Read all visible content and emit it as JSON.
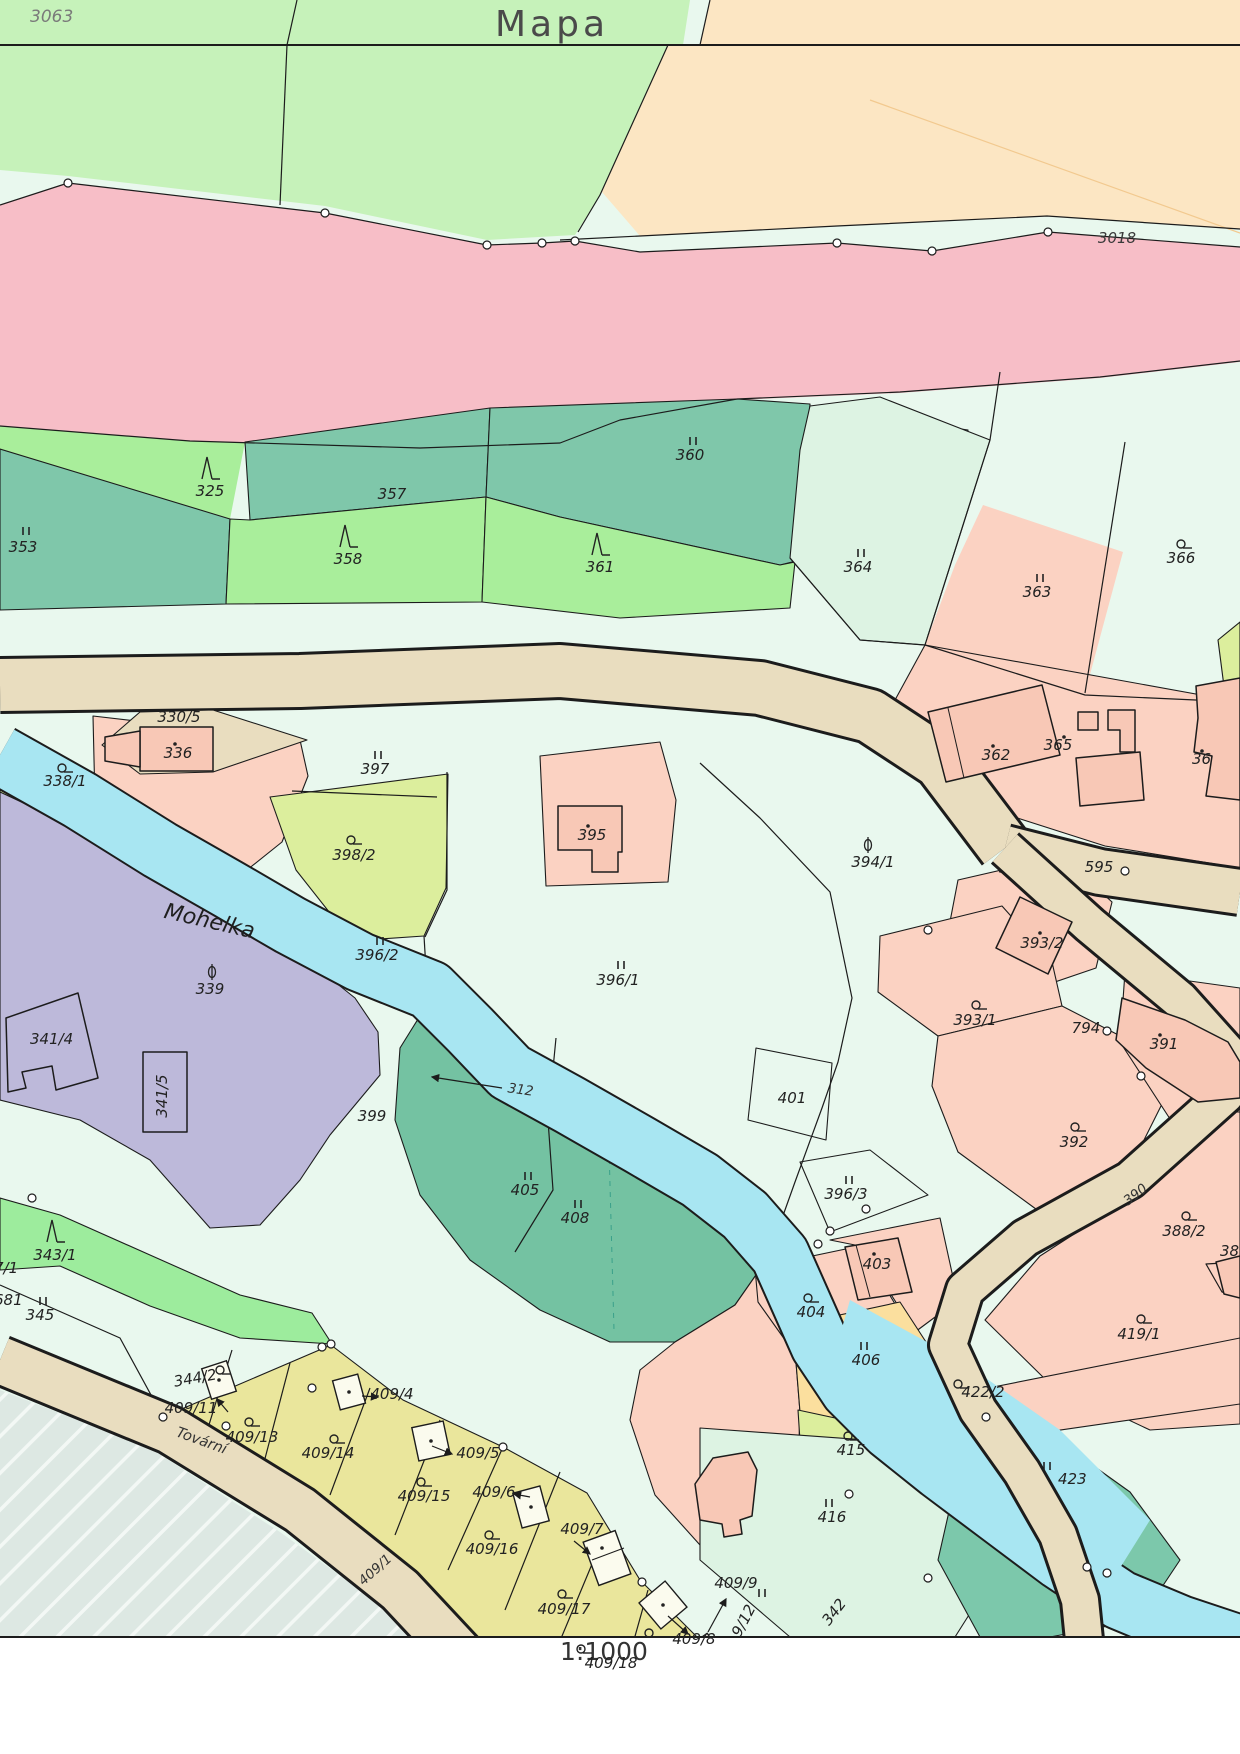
{
  "sheet": {
    "title": "Mapa",
    "scale": "1:1000",
    "sheet_number_top_left": "3063",
    "road_parcel_top_right": "3018",
    "river_name": "Mohelka",
    "street_name": "Tovární"
  },
  "colors": {
    "road_beige": "#e9ddbf",
    "water_cyan": "#a8e6f2",
    "forest_teal": "#7fc7aa",
    "meadow_mint": "#e9f8ee",
    "garden_salmon": "#fbd2c2",
    "field_green": "#a9ee9b",
    "builtup_yellow": "#eae69c",
    "band_pink": "#f7bec7",
    "field_peach": "#fce6c3",
    "area_purple": "#bdb9da",
    "grass_yellowgreen": "#dcee9d",
    "other_gray": "#dde8e3"
  },
  "labels": [
    {
      "t": "3063",
      "x": 30,
      "y": 22,
      "c": "c-sheet",
      "a": "s"
    },
    {
      "t": "Mapa",
      "x": 552,
      "y": 36,
      "c": "c-title"
    },
    {
      "t": "3018",
      "x": 1117,
      "y": 243,
      "c": "c-small"
    },
    {
      "t": "1:1000",
      "x": 604,
      "y": 1660,
      "c": "c-scale"
    },
    {
      "t": "353",
      "x": 23,
      "y": 552,
      "s": "meadow",
      "sx": 26,
      "sy": 532
    },
    {
      "t": "325",
      "x": 210,
      "y": 496,
      "s": "conifer",
      "sx": 207,
      "sy": 470
    },
    {
      "t": "357",
      "x": 392,
      "y": 499
    },
    {
      "t": "358",
      "x": 348,
      "y": 564,
      "s": "conifer",
      "sx": 345,
      "sy": 538
    },
    {
      "t": "360",
      "x": 690,
      "y": 460,
      "s": "meadow",
      "sx": 693,
      "sy": 442
    },
    {
      "t": "361",
      "x": 600,
      "y": 572,
      "s": "conifer",
      "sx": 597,
      "sy": 546
    },
    {
      "t": "364",
      "x": 858,
      "y": 572,
      "s": "meadow",
      "sx": 861,
      "sy": 554
    },
    {
      "t": "363",
      "x": 1037,
      "y": 597,
      "s": "meadow",
      "sx": 1040,
      "sy": 579
    },
    {
      "t": "366",
      "x": 1181,
      "y": 563,
      "s": "garden",
      "sx": 1181,
      "sy": 546
    },
    {
      "t": "330/5",
      "x": 179,
      "y": 722
    },
    {
      "t": "336",
      "x": 178,
      "y": 758,
      "s": "dot",
      "sx": 175,
      "sy": 744
    },
    {
      "t": "338/1",
      "x": 65,
      "y": 786,
      "s": "garden",
      "sx": 62,
      "sy": 770
    },
    {
      "t": "397",
      "x": 375,
      "y": 774,
      "s": "meadow",
      "sx": 378,
      "sy": 756
    },
    {
      "t": "398/2",
      "x": 354,
      "y": 860,
      "s": "garden",
      "sx": 351,
      "sy": 842
    },
    {
      "t": "395",
      "x": 592,
      "y": 840,
      "s": "dot",
      "sx": 588,
      "sy": 826
    },
    {
      "t": "362",
      "x": 996,
      "y": 760,
      "s": "dot",
      "sx": 993,
      "sy": 746
    },
    {
      "t": "365",
      "x": 1058,
      "y": 750,
      "s": "dot",
      "sx": 1064,
      "sy": 737
    },
    {
      "t": "36",
      "x": 1192,
      "y": 764,
      "a": "s",
      "s": "dot",
      "sx": 1202,
      "sy": 751
    },
    {
      "t": "394/1",
      "x": 873,
      "y": 867,
      "s": "station",
      "sx": 868,
      "sy": 845
    },
    {
      "t": "595",
      "x": 1099,
      "y": 872
    },
    {
      "t": "Mohelka",
      "x": 208,
      "y": 928,
      "c": "c-river",
      "r": 13
    },
    {
      "t": "339",
      "x": 210,
      "y": 994,
      "s": "station",
      "sx": 212,
      "sy": 972
    },
    {
      "t": "341/4",
      "x": 30,
      "y": 1044,
      "a": "s"
    },
    {
      "t": "341/5",
      "x": 167,
      "y": 1096,
      "r": -90
    },
    {
      "t": "396/2",
      "x": 377,
      "y": 960,
      "s": "meadow",
      "sx": 380,
      "sy": 942
    },
    {
      "t": "396/1",
      "x": 618,
      "y": 985,
      "s": "meadow",
      "sx": 621,
      "sy": 966
    },
    {
      "t": "393/2",
      "x": 1042,
      "y": 948,
      "s": "dot",
      "sx": 1040,
      "sy": 933
    },
    {
      "t": "393/1",
      "x": 975,
      "y": 1025,
      "s": "garden",
      "sx": 976,
      "sy": 1007
    },
    {
      "t": "794",
      "x": 1086,
      "y": 1033
    },
    {
      "t": "391",
      "x": 1164,
      "y": 1049,
      "s": "dot",
      "sx": 1160,
      "sy": 1035
    },
    {
      "t": "392",
      "x": 1074,
      "y": 1147,
      "s": "garden",
      "sx": 1075,
      "sy": 1129
    },
    {
      "t": "390",
      "x": 1138,
      "y": 1198,
      "c": "c-road",
      "r": -38
    },
    {
      "t": "388/2",
      "x": 1184,
      "y": 1236,
      "s": "garden",
      "sx": 1186,
      "sy": 1218
    },
    {
      "t": "388",
      "x": 1220,
      "y": 1256,
      "a": "s"
    },
    {
      "t": "419/1",
      "x": 1139,
      "y": 1339,
      "s": "garden",
      "sx": 1141,
      "sy": 1321
    },
    {
      "t": "401",
      "x": 792,
      "y": 1103
    },
    {
      "t": "396/3",
      "x": 846,
      "y": 1199,
      "s": "meadow",
      "sx": 849,
      "sy": 1181
    },
    {
      "t": "399",
      "x": 372,
      "y": 1121
    },
    {
      "t": "312",
      "x": 520,
      "y": 1094,
      "c": "c-road",
      "r": 8
    },
    {
      "t": "405",
      "x": 525,
      "y": 1195,
      "s": "meadow",
      "sx": 528,
      "sy": 1177
    },
    {
      "t": "408",
      "x": 575,
      "y": 1223,
      "s": "meadow",
      "sx": 578,
      "sy": 1205
    },
    {
      "t": "403",
      "x": 877,
      "y": 1269,
      "s": "dot",
      "sx": 874,
      "sy": 1254
    },
    {
      "t": "404",
      "x": 811,
      "y": 1317,
      "s": "garden",
      "sx": 808,
      "sy": 1300
    },
    {
      "t": "406",
      "x": 866,
      "y": 1365,
      "s": "meadow",
      "sx": 864,
      "sy": 1347
    },
    {
      "t": "415",
      "x": 851,
      "y": 1455,
      "s": "garden",
      "sx": 848,
      "sy": 1438
    },
    {
      "t": "416",
      "x": 832,
      "y": 1522,
      "s": "meadow",
      "sx": 829,
      "sy": 1504
    },
    {
      "t": "422/2",
      "x": 983,
      "y": 1397,
      "s": "garden",
      "sx": 958,
      "sy": 1386
    },
    {
      "t": "423",
      "x": 1058,
      "y": 1484,
      "a": "s",
      "s": "meadow",
      "sx": 1047,
      "sy": 1467
    },
    {
      "t": "343/1",
      "x": 55,
      "y": 1260,
      "s": "conifer",
      "sx": 52,
      "sy": 1233
    },
    {
      "t": "345",
      "x": 40,
      "y": 1320,
      "s": "meadow",
      "sx": 43,
      "sy": 1302
    },
    {
      "t": "7/1",
      "x": -6,
      "y": 1273,
      "a": "s"
    },
    {
      "t": "681",
      "x": -6,
      "y": 1305,
      "a": "s"
    },
    {
      "t": "344/2",
      "x": 196,
      "y": 1383,
      "r": -10,
      "s": "garden",
      "sx": 220,
      "sy": 1372
    },
    {
      "t": "409/11",
      "x": 191,
      "y": 1413
    },
    {
      "t": "409/13",
      "x": 252,
      "y": 1442,
      "s": "garden",
      "sx": 249,
      "sy": 1424
    },
    {
      "t": "409/4",
      "x": 392,
      "y": 1399
    },
    {
      "t": "409/14",
      "x": 328,
      "y": 1458,
      "s": "garden",
      "sx": 334,
      "sy": 1441
    },
    {
      "t": "409/5",
      "x": 478,
      "y": 1458
    },
    {
      "t": "409/15",
      "x": 424,
      "y": 1501,
      "s": "garden",
      "sx": 421,
      "sy": 1484
    },
    {
      "t": "409/6",
      "x": 494,
      "y": 1497
    },
    {
      "t": "409/16",
      "x": 492,
      "y": 1554,
      "s": "garden",
      "sx": 489,
      "sy": 1537
    },
    {
      "t": "409/7",
      "x": 582,
      "y": 1534
    },
    {
      "t": "409/17",
      "x": 564,
      "y": 1614,
      "s": "garden",
      "sx": 562,
      "sy": 1596
    },
    {
      "t": "409/18",
      "x": 611,
      "y": 1668,
      "s": "garden",
      "sx": 581,
      "sy": 1651
    },
    {
      "t": "409/8",
      "x": 694,
      "y": 1644,
      "s": "garden",
      "sx": 649,
      "sy": 1635
    },
    {
      "t": "409/9",
      "x": 736,
      "y": 1588
    },
    {
      "t": "9/12",
      "x": 748,
      "y": 1623,
      "r": -62,
      "s": "meadow",
      "sx": 762,
      "sy": 1594
    },
    {
      "t": "342",
      "x": 838,
      "y": 1615,
      "r": -52
    },
    {
      "t": "409/1",
      "x": 378,
      "y": 1573,
      "c": "c-road",
      "r": -42
    },
    {
      "t": "Tovární",
      "x": 200,
      "y": 1445,
      "c": "c-street",
      "r": 20
    }
  ]
}
